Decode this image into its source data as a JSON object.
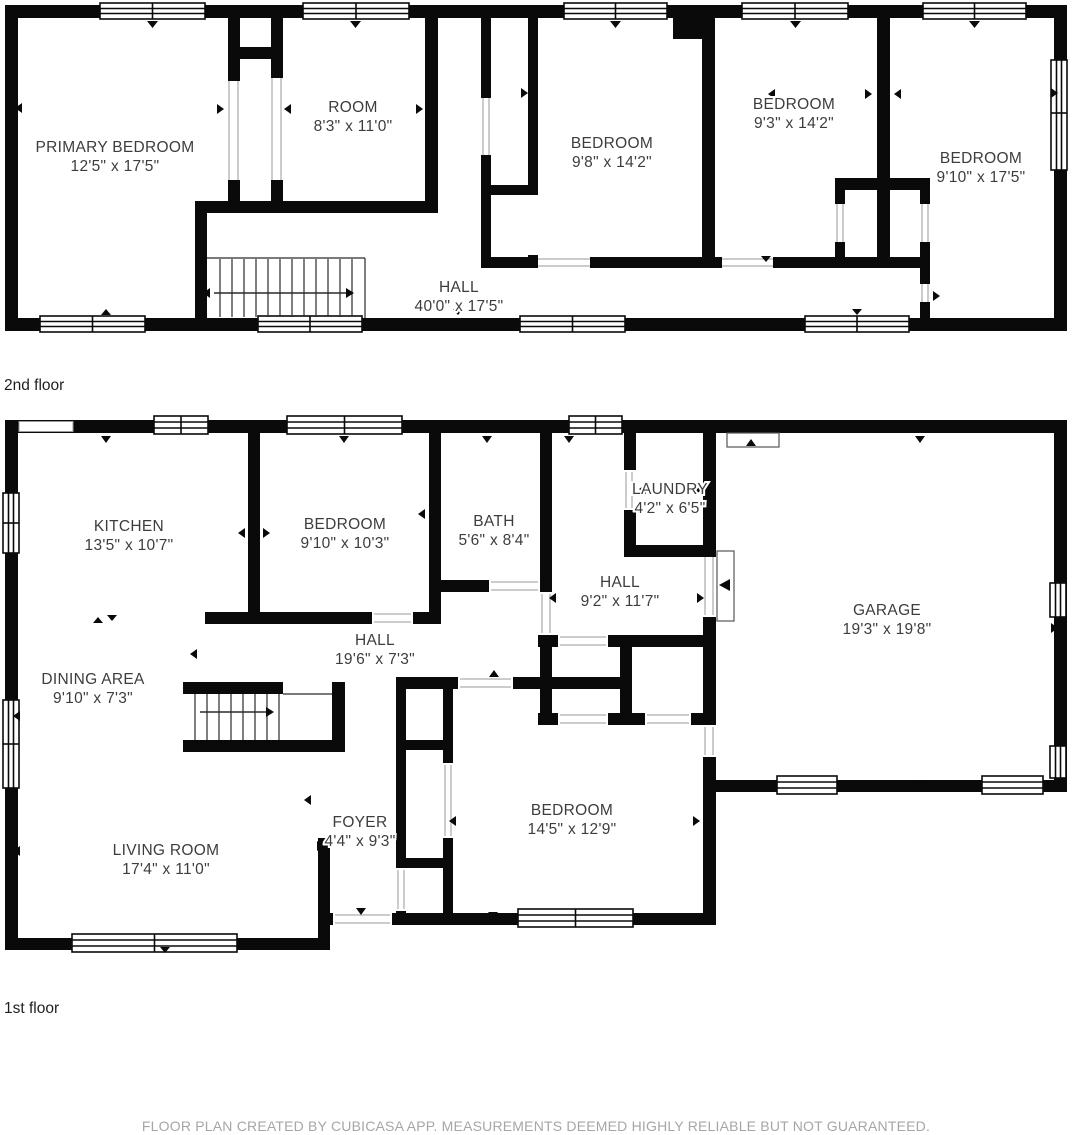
{
  "title": "Floor plan",
  "colors": {
    "wall": "#0a0a0a",
    "room_label": "#3d3d3d",
    "floor_label": "#1f1f1f",
    "footer": "#a6a6a6",
    "opening_line": "#9a9a9a",
    "background": "#ffffff"
  },
  "floors": [
    {
      "label": "2nd floor",
      "rooms": [
        {
          "name": "PRIMARY BEDROOM",
          "dims": "12'5\" x 17'5\""
        },
        {
          "name": "ROOM",
          "dims": "8'3\" x 11'0\""
        },
        {
          "name": "BEDROOM",
          "dims": "9'8\" x 14'2\""
        },
        {
          "name": "BEDROOM",
          "dims": "9'3\" x 14'2\""
        },
        {
          "name": "BEDROOM",
          "dims": "9'10\" x 17'5\""
        },
        {
          "name": "HALL",
          "dims": "40'0\" x 17'5\""
        }
      ]
    },
    {
      "label": "1st floor",
      "rooms": [
        {
          "name": "KITCHEN",
          "dims": "13'5\" x 10'7\""
        },
        {
          "name": "BEDROOM",
          "dims": "9'10\" x 10'3\""
        },
        {
          "name": "BATH",
          "dims": "5'6\" x 8'4\""
        },
        {
          "name": "LAUNDRY",
          "dims": "4'2\" x 6'5\""
        },
        {
          "name": "HALL",
          "dims": "9'2\" x 11'7\""
        },
        {
          "name": "GARAGE",
          "dims": "19'3\" x 19'8\""
        },
        {
          "name": "HALL",
          "dims": "19'6\" x 7'3\""
        },
        {
          "name": "DINING AREA",
          "dims": "9'10\" x 7'3\""
        },
        {
          "name": "FOYER",
          "dims": "4'4\" x 9'3\""
        },
        {
          "name": "LIVING ROOM",
          "dims": "17'4\" x 11'0\""
        },
        {
          "name": "BEDROOM",
          "dims": "14'5\" x 12'9\""
        }
      ]
    }
  ],
  "footer": {
    "text": "FLOOR PLAN CREATED BY CUBICASA APP. MEASUREMENTS DEEMED HIGHLY RELIABLE BUT NOT GUARANTEED."
  }
}
